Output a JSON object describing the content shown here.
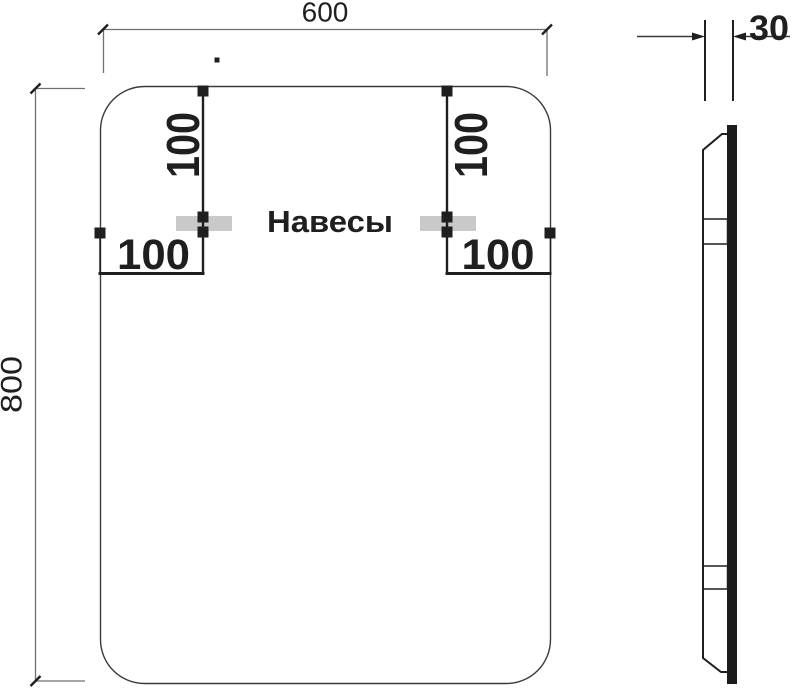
{
  "dimensions": {
    "width": "600",
    "height": "800",
    "thickness": "30",
    "hanger_top_offset_left": "100",
    "hanger_top_offset_right": "100",
    "hanger_side_offset_left": "100",
    "hanger_side_offset_right": "100"
  },
  "labels": {
    "hangers": "Навесы"
  },
  "colors": {
    "background": "#ffffff",
    "dim_line": "#707070",
    "outline": "#3a3a3a",
    "ink": "#1f1f1f",
    "hanger_fill": "#c9c9c9",
    "glass_fill": "#1c1c1c",
    "text": "#1f1f1f"
  }
}
